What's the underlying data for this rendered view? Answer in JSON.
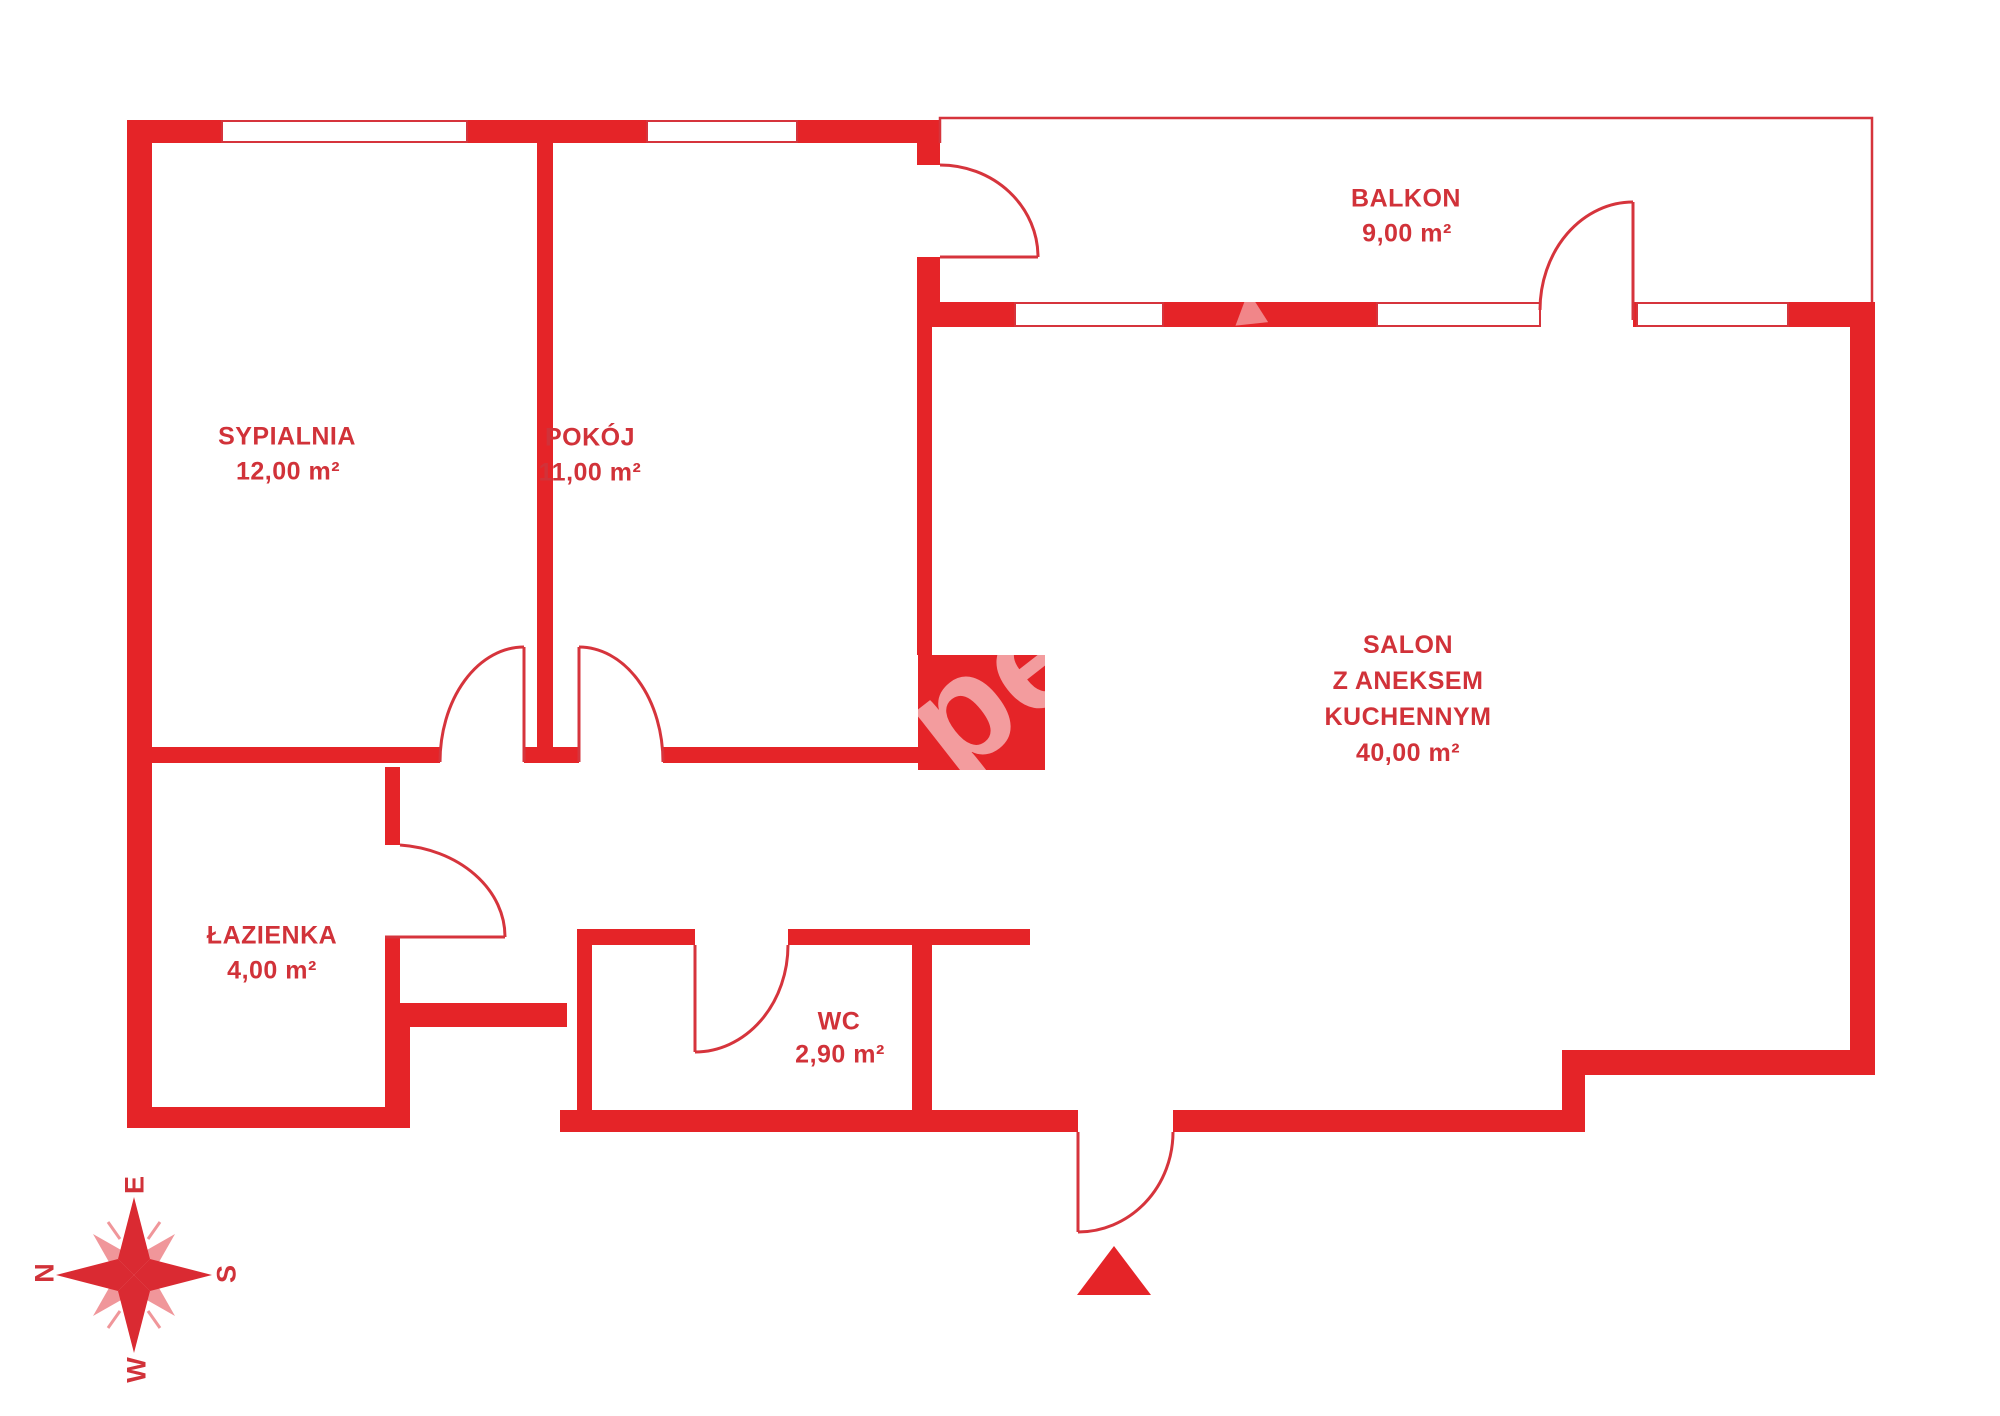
{
  "plan": {
    "title": "apartment-floor-plan",
    "rooms": [
      {
        "id": "sypialnia",
        "name": "SYPIALNIA",
        "area": "12,00 m²"
      },
      {
        "id": "pokoj",
        "name": "POKÓJ",
        "area": "11,00 m²"
      },
      {
        "id": "balkon",
        "name": "BALKON",
        "area": "9,00 m²"
      },
      {
        "id": "salon",
        "name": "SALON",
        "name_line2": "Z ANEKSEM",
        "name_line3": "KUCHENNYM",
        "area": "40,00 m²"
      },
      {
        "id": "lazienka",
        "name": "ŁAZIENKA",
        "area": "4,00 m²"
      },
      {
        "id": "wc",
        "name": "WC",
        "area": "2,90 m²"
      }
    ],
    "compass": {
      "n": "N",
      "e": "E",
      "s": "S",
      "w": "W"
    },
    "watermark": {
      "fragment1": "pe",
      "fragment2": "▲"
    },
    "colors": {
      "wall": "#E52428",
      "line": "#D6343C",
      "text": "#D13239",
      "compass_light": "#F0969A",
      "background": "#FFFFFF"
    }
  }
}
